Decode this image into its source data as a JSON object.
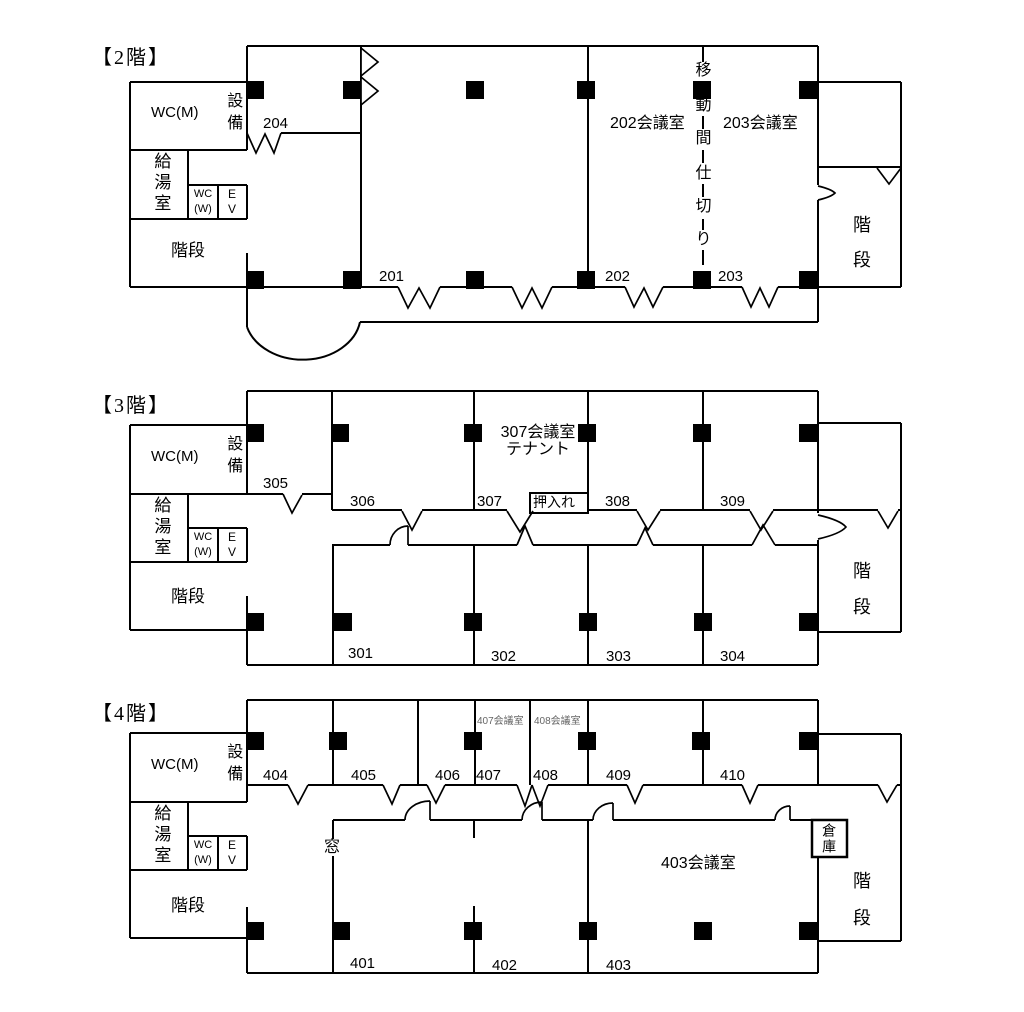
{
  "document_title": "building floor plans",
  "colors": {
    "wall": "#000000",
    "muted_label": "#666666",
    "background": "#ffffff"
  },
  "utility_block": {
    "wc_m": "WC(M)",
    "equipment": "設備",
    "kitchen": "給湯室",
    "wc_w_line1": "WC",
    "wc_w_line2": "(W)",
    "ev_line1": "E",
    "ev_line2": "V",
    "stairs": "階段"
  },
  "stairs_label": {
    "char1": "階",
    "char2": "段"
  },
  "floor2": {
    "title": "【2階】",
    "partition_chars": [
      "移",
      "動",
      "間",
      "仕",
      "切",
      "り"
    ],
    "rooms": {
      "meeting202": "202会議室",
      "meeting203": "203会議室"
    },
    "door_labels": {
      "d201": "201",
      "d202": "202",
      "d203": "203",
      "d204": "204"
    }
  },
  "floor3": {
    "title": "【3階】",
    "rooms": {
      "meeting307_line1": "307会議室",
      "meeting307_line2": "テナント",
      "oshiire": "押入れ"
    },
    "door_labels": {
      "d301": "301",
      "d302": "302",
      "d303": "303",
      "d304": "304",
      "d305": "305",
      "d306": "306",
      "d307": "307",
      "d308": "308",
      "d309": "309"
    }
  },
  "floor4": {
    "title": "【4階】",
    "rooms": {
      "meeting403": "403会議室",
      "souko": "倉庫",
      "window": "窓",
      "meeting407": "407会議室",
      "meeting408": "408会議室"
    },
    "door_labels": {
      "d401": "401",
      "d402": "402",
      "d403": "403",
      "d404": "404",
      "d405": "405",
      "d406": "406",
      "d407": "407",
      "d408": "408",
      "d409": "409",
      "d410": "410"
    }
  }
}
